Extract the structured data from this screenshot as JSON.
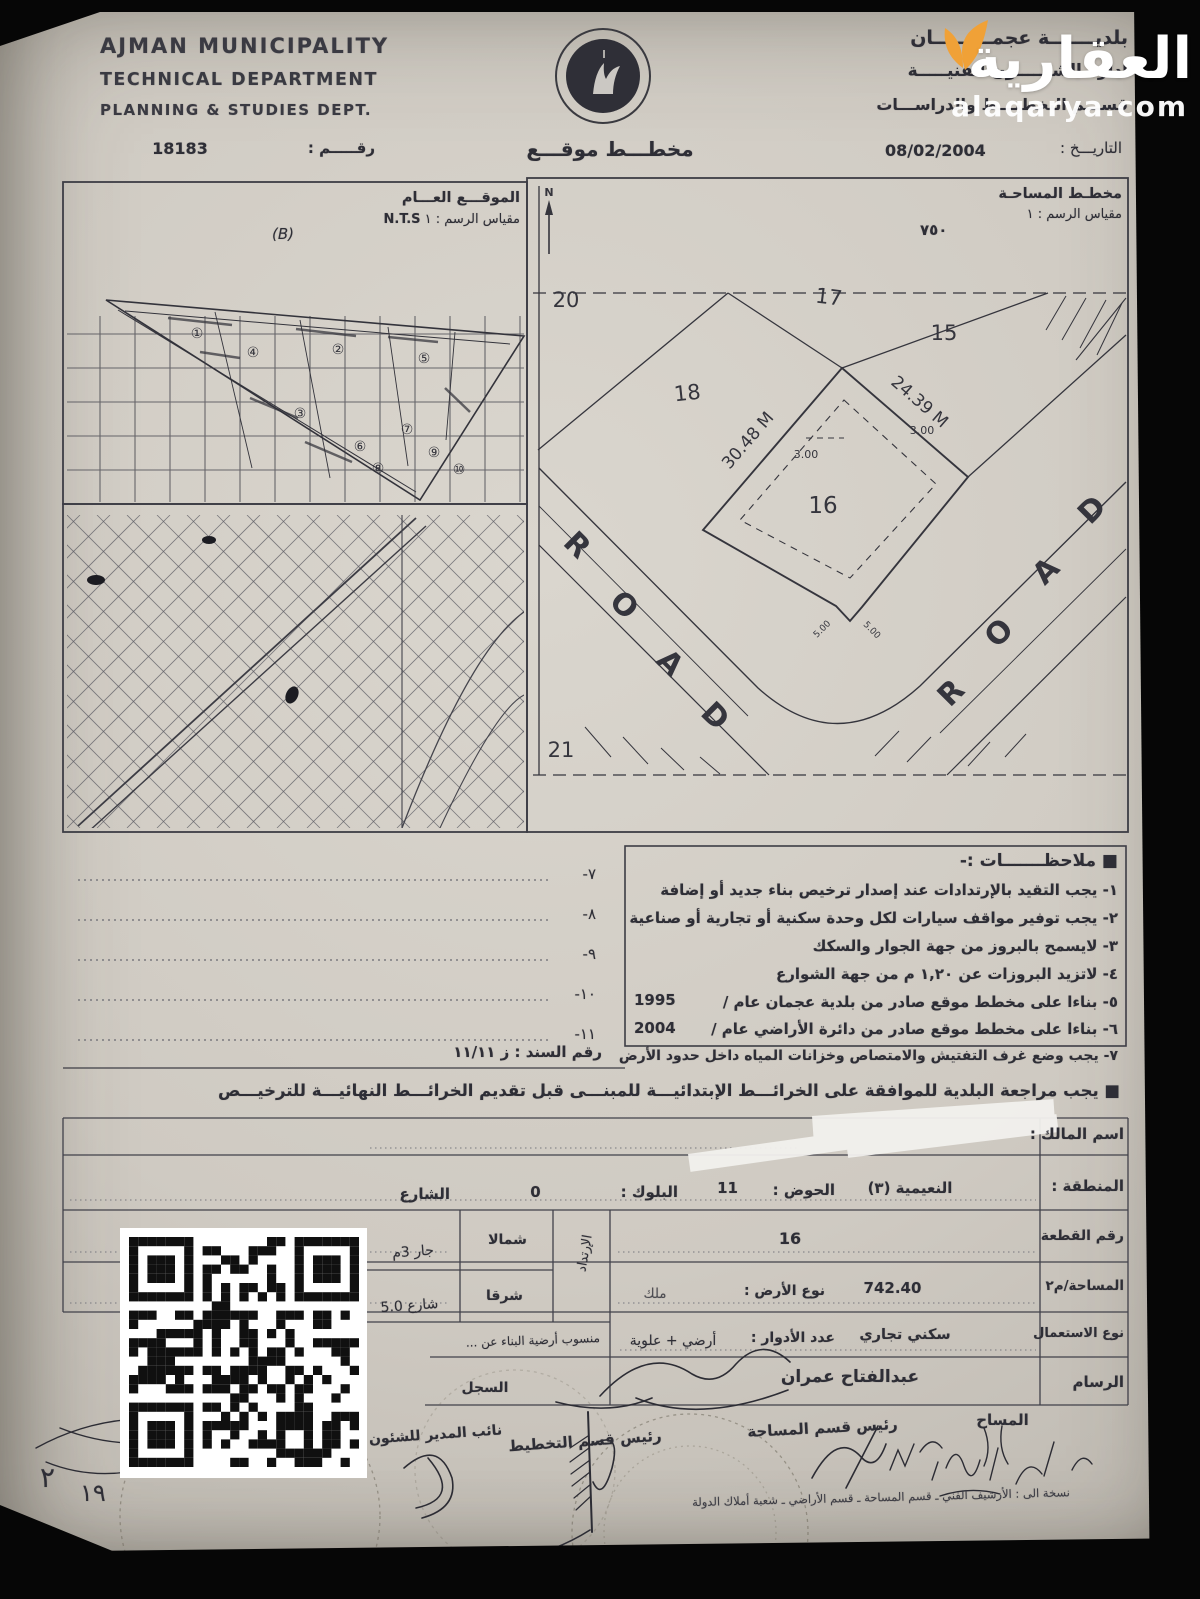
{
  "watermark": {
    "brand": "العقارية",
    "domain": "alaqarya.com",
    "accent_color": "#F0A137",
    "text_color": "#ffffff"
  },
  "header": {
    "org_lines": [
      "AJMAN MUNICIPALITY",
      "TECHNICAL DEPARTMENT",
      "PLANNING & STUDIES DEPT."
    ],
    "number_label": "رقـــــم :",
    "number": "18183",
    "title": "مخطـــط موقـــع",
    "dept_lines": [
      "بلديـــــــة عجمـــــــــان",
      "ادارة الشئـــــون الفنيـــــة",
      "قســـم التخطيـــط والدراســـات"
    ],
    "date_label": "التاريـــخ :",
    "date": "08/02/2004"
  },
  "general_location": {
    "title": "الموقـــع العـــام",
    "scale_label": "مقياس الرسم : ١",
    "scale_value": "N.T.S",
    "zone_tag": "(B)",
    "zone_numbers": [
      "①",
      "②",
      "③",
      "④",
      "⑤",
      "⑥",
      "⑦",
      "⑧",
      "⑨",
      "⑩"
    ]
  },
  "site_plan": {
    "title": "مخطـط المساحـة",
    "scale_label": "مقياس الرسم : ١",
    "scale_value": "٧٥٠",
    "north": "N",
    "plots": {
      "p15": "15",
      "p16": "16",
      "p17": "17",
      "p18": "18",
      "p20": "20",
      "p21": "21"
    },
    "dims": {
      "edge_left": "30.48 M",
      "edge_right": "24.39 M",
      "setback_left": "3.00",
      "setback_right": "3.00",
      "chamfer_left": "5.00",
      "chamfer_right": "5.00"
    },
    "road_letters": [
      "R",
      "O",
      "A",
      "D"
    ]
  },
  "notes": {
    "title": "■ ملاحظـــــــات :-",
    "items": [
      "١- يجب التقيد بالإرتدادات عند إصدار ترخيص بناء جديد أو إضافة",
      "٢- يجب توفير مواقف سيارات لكل وحدة سكنية أو تجارية أو صناعية",
      "٣- لايسمح بالبروز من جهة الجوار والسكك",
      "٤- لاتزيد البروزات عن ١,٢٠ م من جهة الشوارع",
      "٥- بناءا على مخطط موقع صادر من بلدية عجمان عام /",
      "٦- بناءا على مخطط موقع صادر من دائرة الأراضي عام /",
      "٧- يجب وضع غرف التفتيش والامتصاص وخزانات المياه داخل حدود الأرض"
    ],
    "year_1": "1995",
    "year_2": "2004",
    "blank_numbers": [
      "٧-",
      "٨-",
      "٩-",
      "١٠-",
      "١١-"
    ],
    "deed_label": "رقم السند :",
    "deed_value": "ز ١١/١١",
    "review_note": "■ يجب مراجعة البلدية للموافقة على الخرائـــط الإبتدائيـــة للمبنـــى قبل تقديم الخرائـــط النهائيـــة للترخيـــص"
  },
  "details": {
    "owner_label": "اسم المالك :",
    "region_label": "المنطقة :",
    "region": "النعيمية (٣)",
    "basin_label": "الحوض :",
    "basin": "11",
    "block_label": "البلوك :",
    "block": "0",
    "street_label": "الشارع",
    "plot_label": "رقم القطعة",
    "plot": "16",
    "area_label": "المساحة/م٢",
    "area": "742.40",
    "land_type_label": "نوع الأرض :",
    "land_type": "ملك",
    "use_label": "نوع الاستعمال",
    "use": "سكني تجاري",
    "floors_label": "عدد الأدوار :",
    "floors": "أرضي + علوية",
    "level_note": "منسوب أرضية البناء عن ...",
    "setback_label": "الإرتداد",
    "setback_north_dir": "شمالا",
    "setback_north_val": "جار 3م",
    "setback_east_dir": "شرقا",
    "setback_east_val": "شارع 5.0",
    "draftsman_label": "الرسام",
    "draftsman": "عبدالفتاح عمران",
    "register_label": "السجل",
    "sig_1": "المساح",
    "sig_2": "رئيس قسم المساحة",
    "sig_3": "رئيس قسم التخطيط",
    "sig_4": "نائب المدير للشئون",
    "copy_note": "نسخة الى : الأرشيف الفني ـ قسم المساحة ـ قسم الأراضي ـ شعبة أملاك الدولة",
    "hand_mark_1": "٢",
    "hand_mark_2": "١٩"
  }
}
